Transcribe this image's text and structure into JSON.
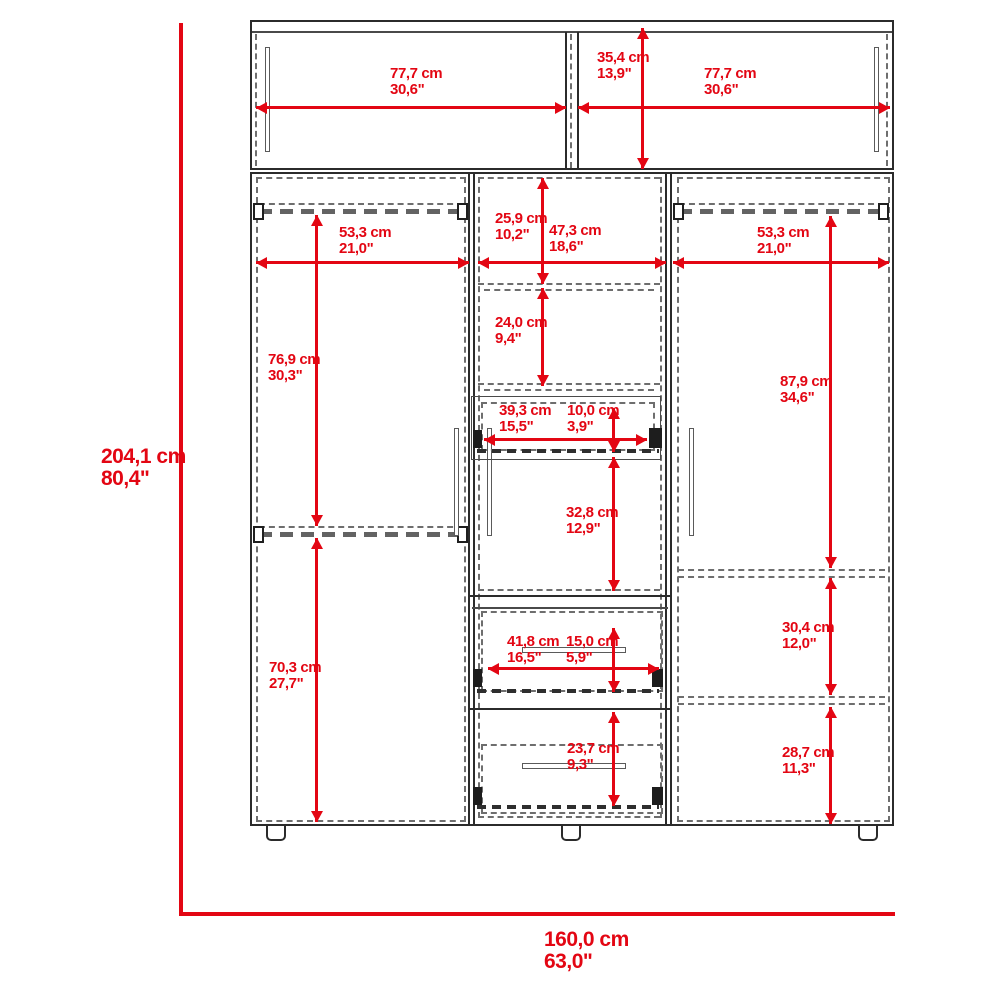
{
  "colors": {
    "dimension_red": "#e30613",
    "outline_dark": "#2b2b2b",
    "dashed_gray": "#6e6e6e"
  },
  "labels": {
    "hutch_left_width": {
      "cm": "77,7 cm",
      "in": "30,6\""
    },
    "hutch_height": {
      "cm": "35,4 cm",
      "in": "13,9\""
    },
    "hutch_right_width": {
      "cm": "77,7 cm",
      "in": "30,6\""
    },
    "left_width": {
      "cm": "53,3 cm",
      "in": "21,0\""
    },
    "left_upper_height": {
      "cm": "76,9 cm",
      "in": "30,3\""
    },
    "left_lower_height": {
      "cm": "70,3 cm",
      "in": "27,7\""
    },
    "mid_top_height": {
      "cm": "25,9 cm",
      "in": "10,2\""
    },
    "mid_width": {
      "cm": "47,3 cm",
      "in": "18,6\""
    },
    "mid_shelf_height": {
      "cm": "24,0 cm",
      "in": "9,4\""
    },
    "drawer1_width": {
      "cm": "39,3 cm",
      "in": "15,5\""
    },
    "drawer1_height": {
      "cm": "10,0 cm",
      "in": "3,9\""
    },
    "mid_open_height": {
      "cm": "32,8 cm",
      "in": "12,9\""
    },
    "drawer2_width": {
      "cm": "41,8 cm",
      "in": "16,5\""
    },
    "drawer2_height": {
      "cm": "15,0 cm",
      "in": "5,9\""
    },
    "drawer3_height": {
      "cm": "23,7 cm",
      "in": "9,3\""
    },
    "right_width": {
      "cm": "53,3 cm",
      "in": "21,0\""
    },
    "right_upper_height": {
      "cm": "87,9 cm",
      "in": "34,6\""
    },
    "right_middle_height": {
      "cm": "30,4 cm",
      "in": "12,0\""
    },
    "right_lower_height": {
      "cm": "28,7 cm",
      "in": "11,3\""
    },
    "overall_height": {
      "cm": "204,1 cm",
      "in": "80,4\""
    },
    "overall_width": {
      "cm": "160,0 cm",
      "in": "63,0\""
    }
  }
}
